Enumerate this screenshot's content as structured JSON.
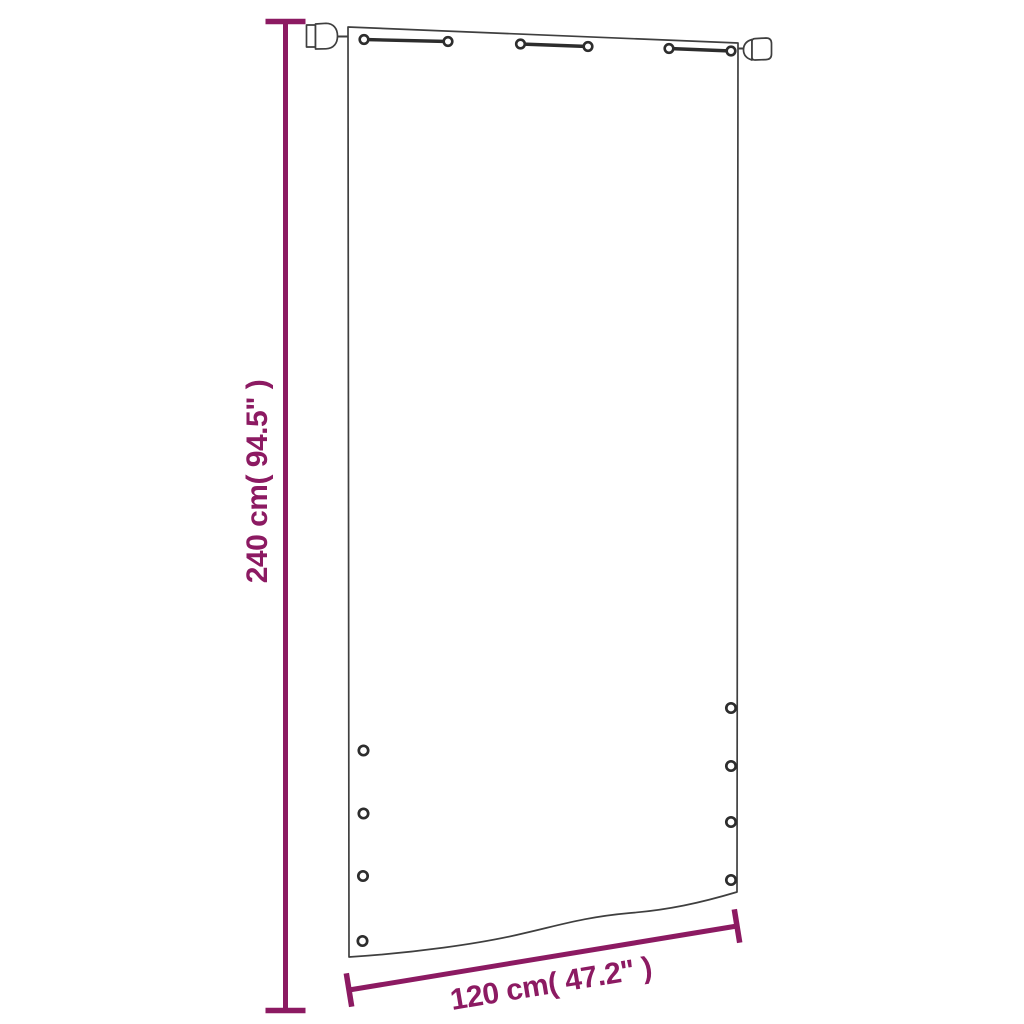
{
  "diagram": {
    "kind": "product-dimension-diagram",
    "height_dimension": {
      "label": "240 cm( 94.5\" )",
      "value_cm": 240,
      "value_inch": 94.5,
      "orientation": "vertical"
    },
    "width_dimension": {
      "label": "120 cm( 47.2\" )",
      "value_cm": 120,
      "value_inch": 47.2,
      "orientation": "diagonal"
    },
    "hardware": {
      "hanging_cords": 3,
      "cord_eyelets": 6,
      "rod_end_caps": 2,
      "grommets_left": 4,
      "grommets_right": 4
    },
    "colors": {
      "accent": "#8C1A62",
      "outline": "#3F3F3F",
      "hardware": "#2D2D2D",
      "background": "#FFFFFF"
    }
  }
}
